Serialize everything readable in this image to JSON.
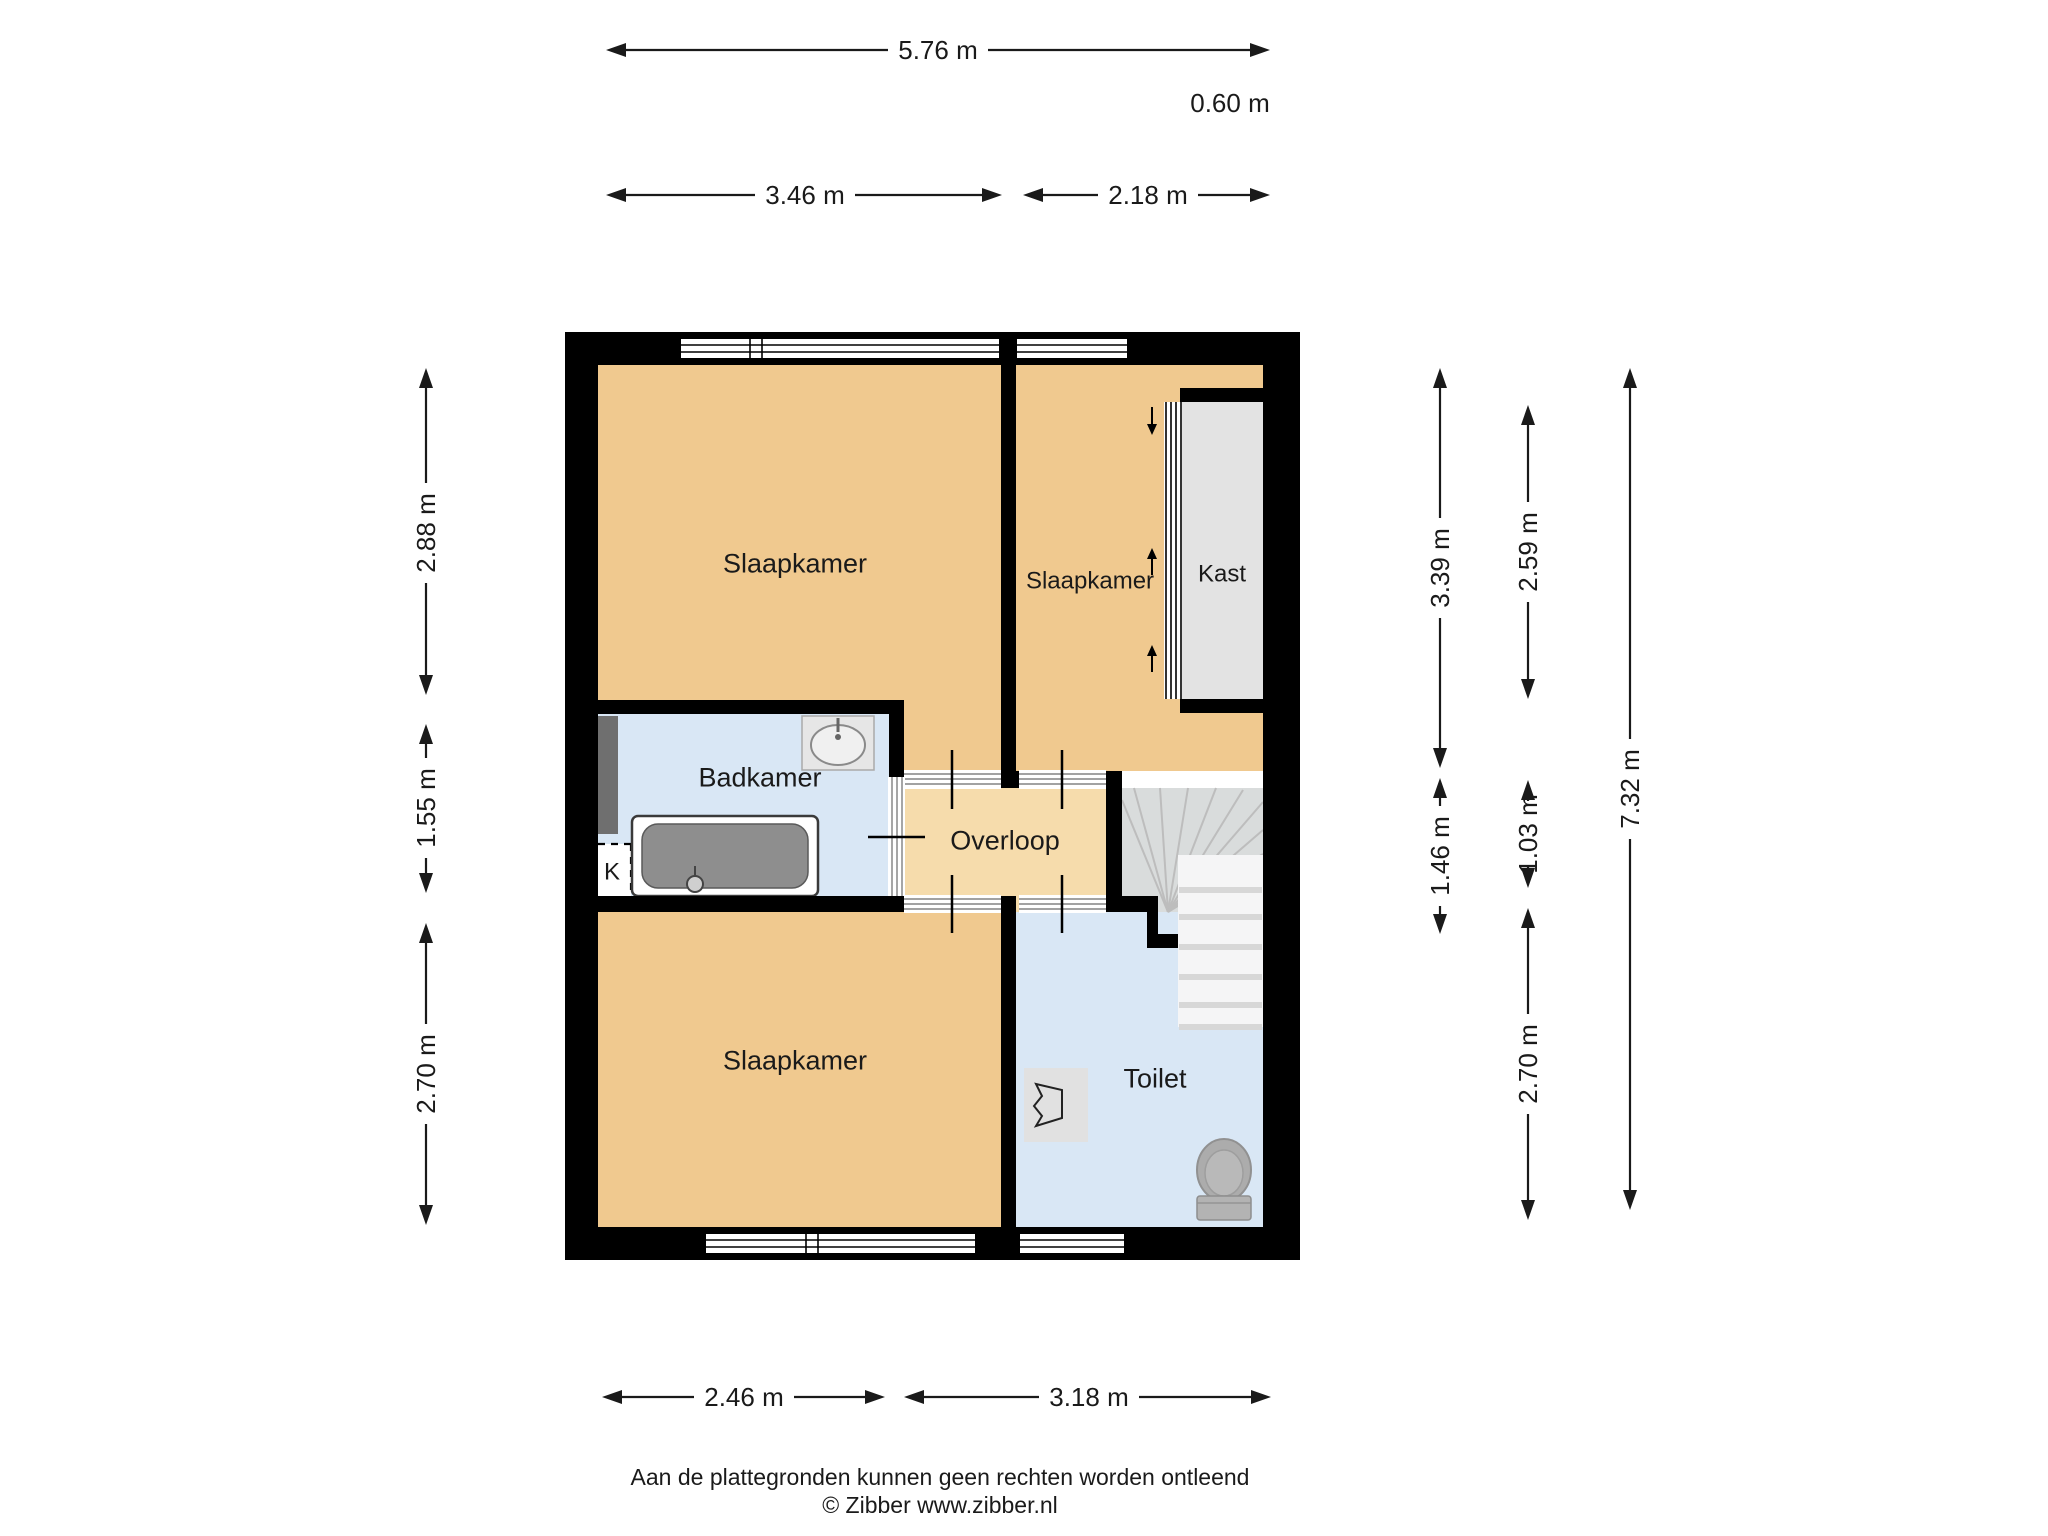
{
  "floorplan": {
    "rooms": {
      "slaapkamer_tl": "Slaapkamer",
      "slaapkamer_tr": "Slaapkamer",
      "slaapkamer_bottom": "Slaapkamer",
      "badkamer": "Badkamer",
      "overloop": "Overloop",
      "toilet": "Toilet",
      "kast": "Kast",
      "k_closet": "K"
    },
    "dimensions": {
      "top_total": "5.76 m",
      "top_offset": "0.60 m",
      "top_left": "3.46 m",
      "top_right": "2.18 m",
      "left_upper": "2.88 m",
      "left_middle": "1.55 m",
      "left_lower": "2.70 m",
      "right_inner_upper": "3.39 m",
      "right_inner_lower": "1.46 m",
      "right_mid_upper": "2.59 m",
      "right_mid_middle": "1.03 m",
      "right_mid_lower": "2.70 m",
      "right_total": "7.32 m",
      "bottom_left": "2.46 m",
      "bottom_right": "3.18 m"
    },
    "footer": {
      "disclaimer": "Aan de plattegronden kunnen geen rechten worden ontleend",
      "copyright": "© Zibber www.zibber.nl"
    },
    "colors": {
      "room_tan": "#F0C98F",
      "overloop_tan": "#F6DCAC",
      "wet_room_blue": "#D9E7F5",
      "closet_gray": "#E3E3E3",
      "stairs_gray": "#D9DCDC",
      "flight_white": "#F5F5F6",
      "shaft_gray": "#6F6F6F",
      "wall_black": "#000000"
    }
  }
}
